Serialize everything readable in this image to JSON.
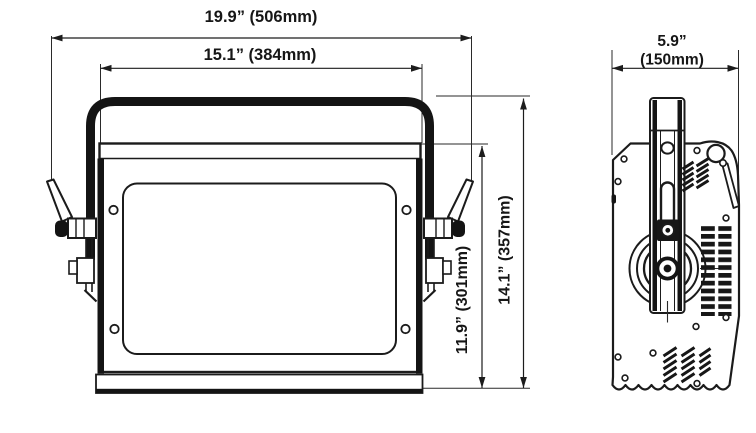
{
  "drawing": {
    "title": "fixture-dimension-drawing",
    "front_view": {
      "overall_width_label": "19.9” (506mm)",
      "inner_width_label": "15.1” (384mm)",
      "inner_height_label": "11.9” (301mm)",
      "overall_height_label": "14.1” (357mm)"
    },
    "side_view": {
      "depth_label_inches": "5.9”",
      "depth_label_mm": "(150mm)"
    },
    "colors": {
      "line": "#1b1b1b",
      "background": "#ffffff"
    }
  }
}
